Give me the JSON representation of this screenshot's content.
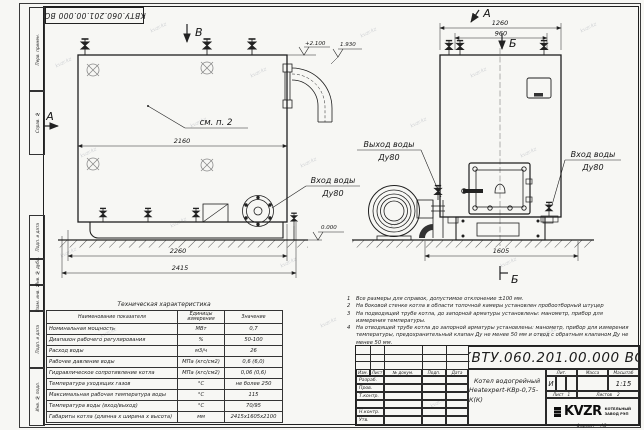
{
  "doc_number": "КВТУ.060.201.00.000 ВО",
  "watermark": "kvzr.kz",
  "margin_labels": {
    "perv": "Перв. примен.",
    "sprav": "Справ. №",
    "podp1": "Подп. и дата",
    "dubl": "Инв. № дубл.",
    "vzam": "Взам. инв. №",
    "podp2": "Подп. и дата",
    "podl": "Инв. № подл."
  },
  "views": {
    "label_a_side": "А",
    "label_v_top": "В",
    "label_a_front": "А",
    "label_b_top": "Б",
    "label_b_bottom": "Б",
    "see_note": "см. п. 2",
    "outlet_line1": "Выход воды",
    "outlet_line2": "Ду80",
    "inlet_left_line1": "Вход воды",
    "inlet_left_line2": "Ду80",
    "inlet_right_line1": "Вход воды",
    "inlet_right_line2": "Ду80"
  },
  "dims": {
    "w2160": "2160",
    "w2260": "2260",
    "w2415": "2415",
    "w1260": "1260",
    "w960": "960",
    "w1605": "1605"
  },
  "elevations": {
    "top": "+2.100",
    "flue": "1.930",
    "ground": "0.000"
  },
  "notes": {
    "items": [
      {
        "n": "1",
        "t": "Все размеры для справок, допустимое отклонение ±100 мм."
      },
      {
        "n": "2",
        "t": "На боковой стенке котла в области топочной камеры установлен пробоотборный штуцер"
      },
      {
        "n": "3",
        "t": "На подводящей трубе котла, до запорной арматуры установлены: манометр, прибор для измерения температуры."
      },
      {
        "n": "4",
        "t": "На отводящей трубе котла до запорной арматуры установлены: манометр, прибор для измерения температуры, предохранительный клапан Ду не менее 50 мм и отвод с обратным клапаном Ду не менее 50 мм."
      }
    ]
  },
  "spec_table": {
    "title": "Техническая характеристика",
    "col_name": "Наименование показателя",
    "col_units": "Единицы измерения",
    "col_value": "Значение",
    "rows": [
      [
        "Номинальная мощность",
        "МВт",
        "0,7"
      ],
      [
        "Диапазон рабочего регулирования",
        "%",
        "50-100"
      ],
      [
        "Расход воды",
        "м3/ч",
        "26"
      ],
      [
        "Рабочее давление воды",
        "МПа (кгс/см2)",
        "0,6 (6,0)"
      ],
      [
        "Гидравлическое сопротивление котла",
        "МПа (кгс/см2)",
        "0,06 (0,6)"
      ],
      [
        "Температура уходящих газов",
        "°С",
        "не более 250"
      ],
      [
        "Максимальная рабочая температура воды",
        "°С",
        "115"
      ],
      [
        "Температура воды (вход/выход)",
        "°С",
        "70/95"
      ],
      [
        "Габариты котла (длинна х ширина х высота)",
        "мм",
        "2415х1605х2100"
      ]
    ]
  },
  "title_block": {
    "doc_number": "КВТУ.060.201.00.000 ВО",
    "name_line1": "Котел водогрейный",
    "name_line2": "Heatexpert-КВр-0,75-К(К)",
    "h_izm": "Изм.",
    "h_list": "Лист",
    "h_ndok": "№ докум.",
    "h_podp": "Подп.",
    "h_data": "Дата",
    "r_razrab": "Разраб.",
    "r_prov": "Пров.",
    "r_tkontr": "Т.контр.",
    "r_nkontr": "Н.контр.",
    "r_utv": "Утв.",
    "h_lit": "Лит.",
    "h_massa": "Масса",
    "h_masshtab": "Масштаб",
    "lit_value": "И",
    "scale_value": "1:15",
    "sheet_label": "Лист",
    "sheet_value": "1",
    "sheets_label": "Листов",
    "sheets_value": "2",
    "logo_text": "KVZR",
    "factory_line1": "КОТЕЛЬНЫЙ",
    "factory_line2": "ЗАВОД РЭП",
    "format_label": "Формат",
    "format_value": "А3"
  }
}
